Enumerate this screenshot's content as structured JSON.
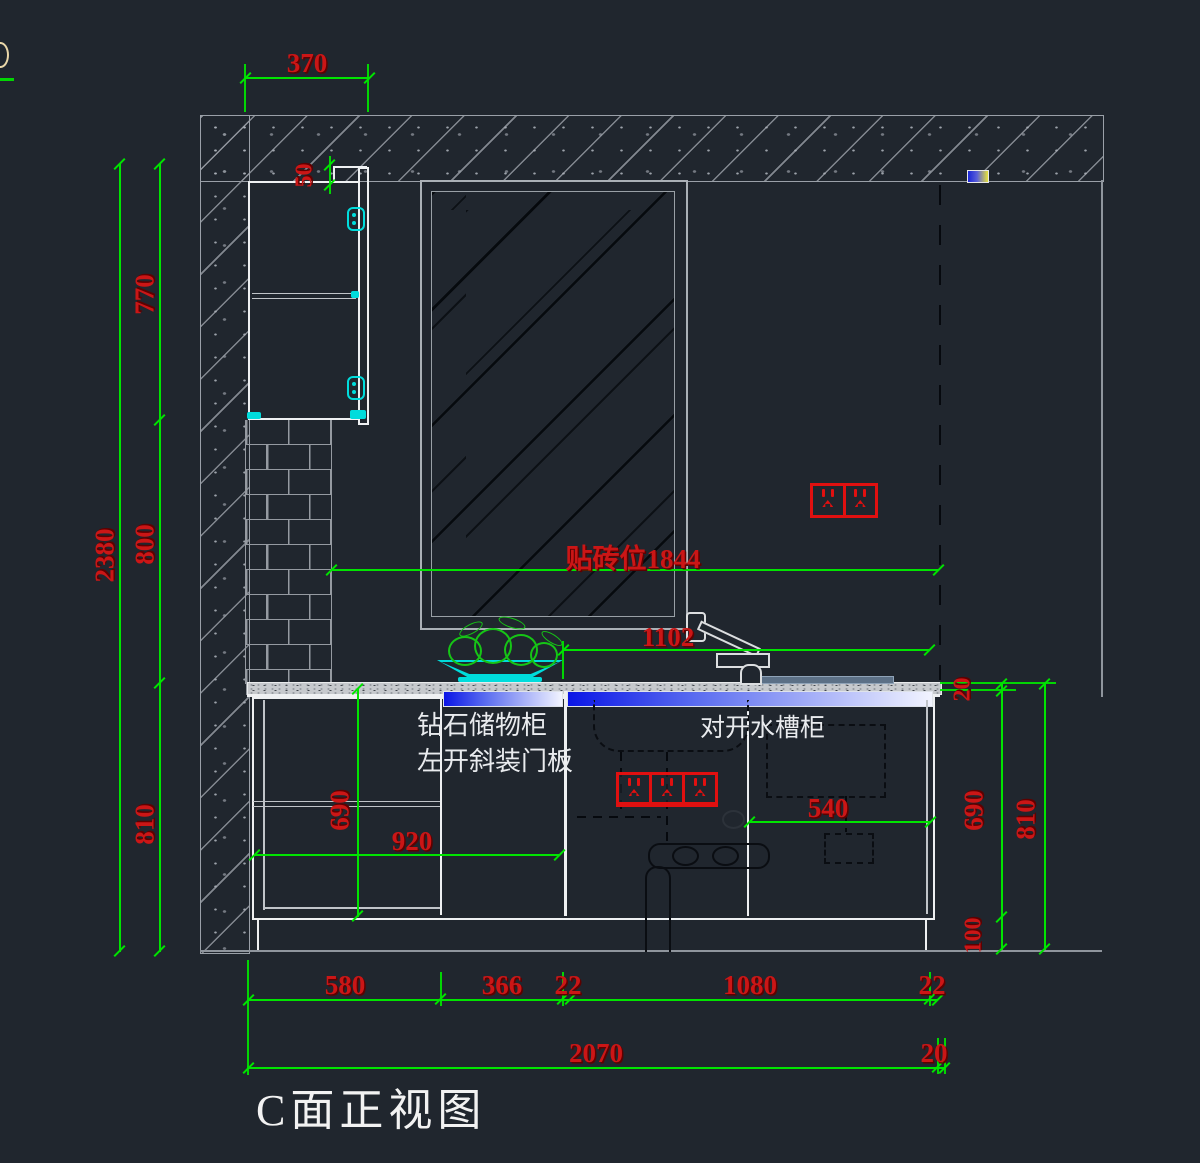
{
  "title": "C面正视图",
  "labels": {
    "storage_cabinet_line1": "钻石储物柜",
    "storage_cabinet_line2": "左开斜装门板",
    "sink_cabinet": "对开水槽柜"
  },
  "dimensions": {
    "top_width": "370",
    "cabinet_top_gap": "50",
    "left_total_height": "2380",
    "left_upper": "770",
    "left_middle": "800",
    "left_lower": "810",
    "tile_zone": "贴砖位1844",
    "faucet_span": "1102",
    "mid_cabinet_height": "690",
    "counter_run": "920",
    "sink_offset": "540",
    "right_counter_thickness": "20",
    "right_cabinet_height": "690",
    "right_kick_height": "100",
    "right_total": "810",
    "bottom_row1": [
      "580",
      "366",
      "22",
      "1080",
      "22"
    ],
    "bottom_row2": [
      "2070",
      "20"
    ]
  },
  "colors": {
    "background": "#20262e",
    "dimension_line": "#00e400",
    "dimension_text": "#cb1616",
    "cabinet_line": "#eef0f2",
    "wall_line": "#9aa0a8",
    "hardware_cyan": "#00dcdc",
    "outlet_red": "#e01010",
    "led_strip_blue": "#0a15e6"
  }
}
